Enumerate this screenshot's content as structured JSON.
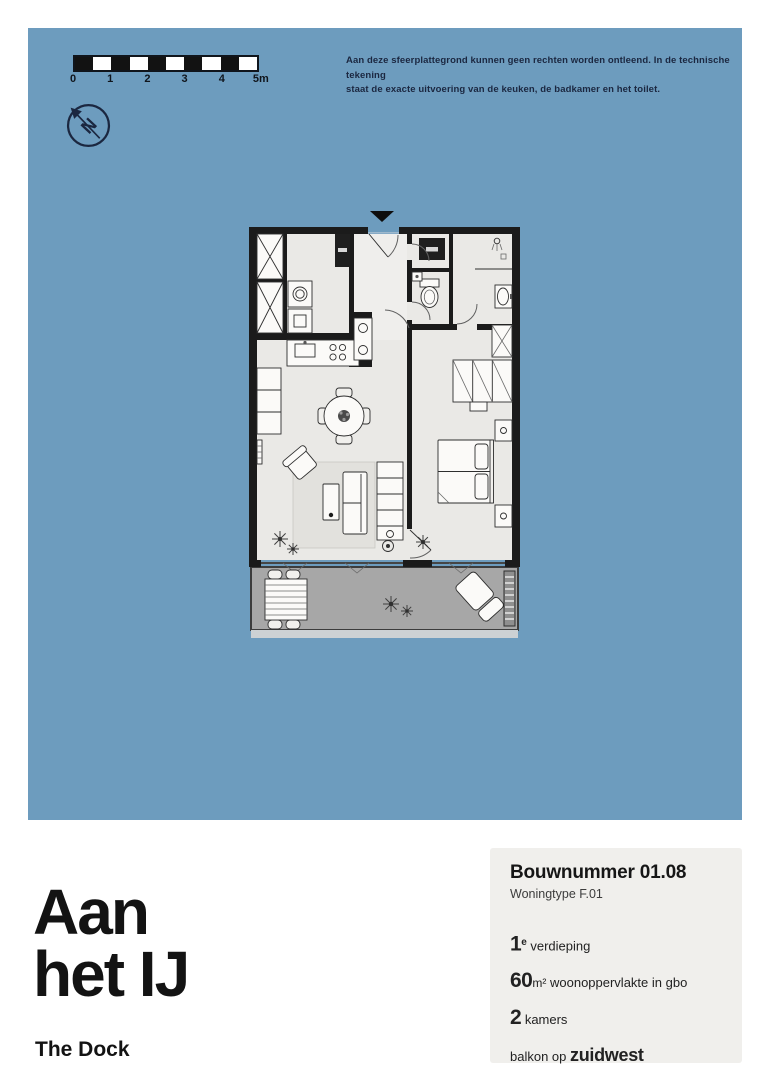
{
  "colors": {
    "panel_blue": "#6d9cbe",
    "ink": "#141414",
    "navy": "#1b2740",
    "card_bg": "#f0efec",
    "floor": "#eae9e6",
    "wall": "#1b1b1b",
    "balcony": "#a7a7a7",
    "balcony_edge": "#3c3c3c"
  },
  "disclaimer": {
    "line1": "Aan deze sfeerplattegrond kunnen geen rechten worden ontleend. In de technische tekening",
    "line2": "staat de exacte uitvoering van de keuken, de badkamer en het toilet."
  },
  "scale_bar": {
    "labels": [
      "0",
      "1",
      "2",
      "3",
      "4",
      "5m"
    ]
  },
  "compass": {
    "label": "N"
  },
  "title": {
    "line1": "Aan",
    "line2": "het IJ"
  },
  "project": {
    "name": "The Dock"
  },
  "info_card": {
    "bouwnummer": "Bouwnummer 01.08",
    "woningtype": "Woningtype F.01",
    "floor": {
      "number": "1",
      "sup": "e",
      "label": "verdieping"
    },
    "area": {
      "number": "60",
      "unit": "m²",
      "label": "woonoppervlakte in gbo"
    },
    "rooms": {
      "number": "2",
      "label": "kamers"
    },
    "balcony": {
      "prefix": "balkon op",
      "direction": "zuidwest"
    }
  }
}
